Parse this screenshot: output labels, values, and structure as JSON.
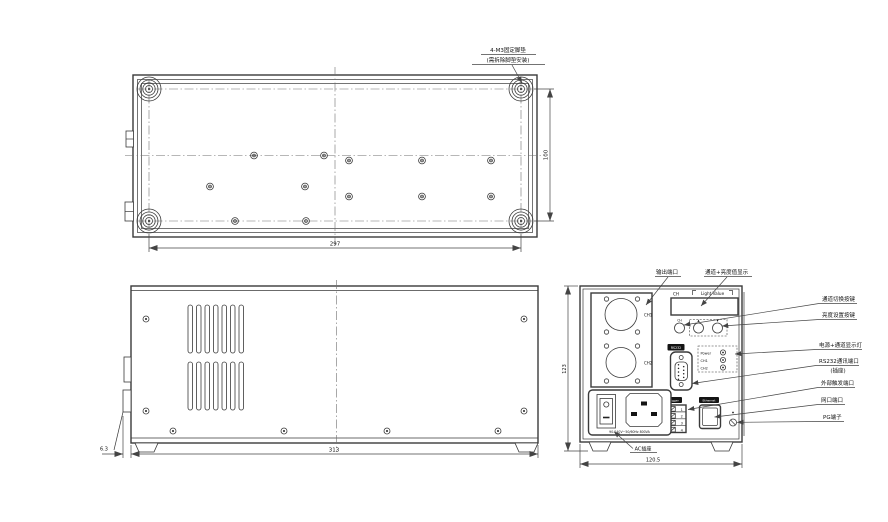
{
  "colors": {
    "line": "#3a3a3a",
    "text": "#111111",
    "background": "#ffffff"
  },
  "top_view": {
    "note_line1": "4-M3固定脚垫",
    "note_line2": "(需拆除脚垫安装)",
    "dim_width": "297",
    "dim_height": "100"
  },
  "side_view": {
    "dim_width": "313",
    "dim_foot_offset": "6.3"
  },
  "rear_view": {
    "dim_width": "120.5",
    "dim_height": "123",
    "output_ch1": "CH1",
    "output_ch2": "CH2",
    "display_ch": "CH",
    "display_value": "Light Value",
    "button_ch": "CH",
    "button_up": "▲",
    "button_down": "▼",
    "rs232": "RS232",
    "led_power": "Power",
    "led_ch1": "CH1",
    "led_ch2": "CH2",
    "trigger": "Trigger",
    "trigger_pins": [
      "1",
      "2",
      "3",
      "4"
    ],
    "ethernet": "Ethernet",
    "ac_rating": "90-240V~50/60Hz 800VA",
    "ac_label": "AC插座"
  },
  "annotations": {
    "output_port": "输出端口",
    "display": "通道+亮度值显示",
    "channel_switch_button": "通道切换按键",
    "brightness_set_button": "亮度设置按键",
    "power_channel_leds": "电源+通道显示灯",
    "rs232_port_line1": "RS232通讯端口",
    "rs232_port_line2": "(插座)",
    "external_trigger_port": "外部触发端口",
    "lan_port": "网口端口",
    "pg_terminal": "PG端子"
  }
}
